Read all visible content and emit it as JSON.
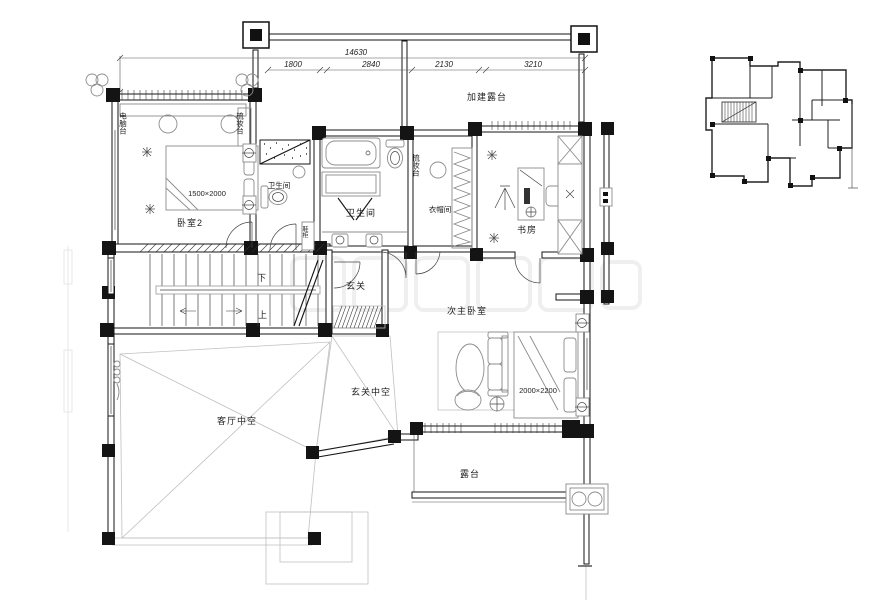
{
  "colors": {
    "wall": "#141414",
    "line": "#444444",
    "furniture": "#8c8c8c",
    "faint": "#c0c0c0",
    "background": "#ffffff"
  },
  "dimensions": {
    "total": "14630",
    "segments": [
      "1800",
      "2840",
      "2130",
      "3210"
    ]
  },
  "rooms": {
    "bedroom2": "卧室2",
    "bedroom2_bed": "1500×2000",
    "computer_desk": "电脑台",
    "dresser_bedroom": "梳妆台",
    "bath_small": "卫生间",
    "bath_main": "卫生间",
    "cloakroom": "衣帽间",
    "dresser_cloak": "梳妆台",
    "study": "书房",
    "added_terrace": "加建露台",
    "entry": "玄关",
    "shoe_cabinet": "鞋柜",
    "stair_down": "下",
    "stair_up": "上",
    "secondary_master": "次主卧室",
    "master_bed": "2000×2200",
    "living_void": "客厅中空",
    "entry_void": "玄关中空",
    "terrace": "露台"
  }
}
